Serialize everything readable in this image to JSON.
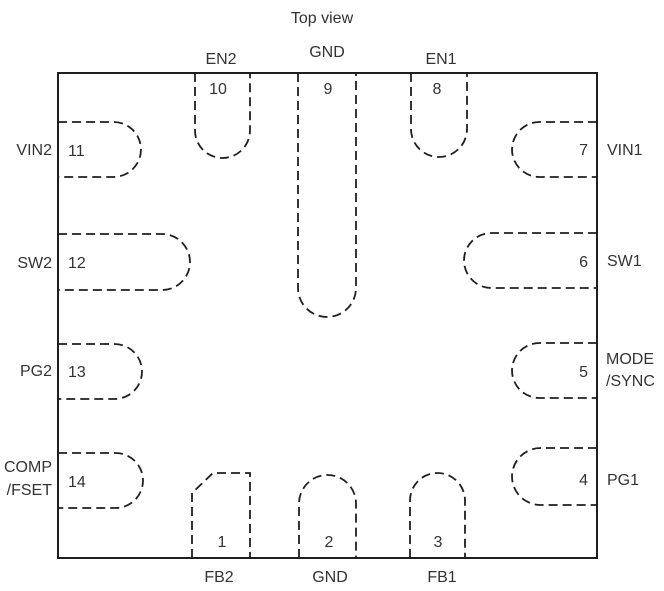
{
  "title": "Top view",
  "colors": {
    "line": "#1f1f1f",
    "text": "#333333",
    "background": "#ffffff"
  },
  "package": {
    "type": "ic-package-top-view",
    "pin_count": 14
  },
  "pins": [
    {
      "num": "1",
      "label": "FB2",
      "side": "bottom"
    },
    {
      "num": "2",
      "label": "GND",
      "side": "bottom"
    },
    {
      "num": "3",
      "label": "FB1",
      "side": "bottom"
    },
    {
      "num": "4",
      "label": "PG1",
      "side": "right"
    },
    {
      "num": "5",
      "label": "MODE",
      "label2": "/SYNC",
      "side": "right"
    },
    {
      "num": "6",
      "label": "SW1",
      "side": "right"
    },
    {
      "num": "7",
      "label": "VIN1",
      "side": "right"
    },
    {
      "num": "8",
      "label": "EN1",
      "side": "top"
    },
    {
      "num": "9",
      "label": "GND",
      "side": "top"
    },
    {
      "num": "10",
      "label": "EN2",
      "side": "top"
    },
    {
      "num": "11",
      "label": "VIN2",
      "side": "left"
    },
    {
      "num": "12",
      "label": "SW2",
      "side": "left"
    },
    {
      "num": "13",
      "label": "PG2",
      "side": "left"
    },
    {
      "num": "14",
      "label": "COMP",
      "label2": "/FSET",
      "side": "left"
    }
  ]
}
